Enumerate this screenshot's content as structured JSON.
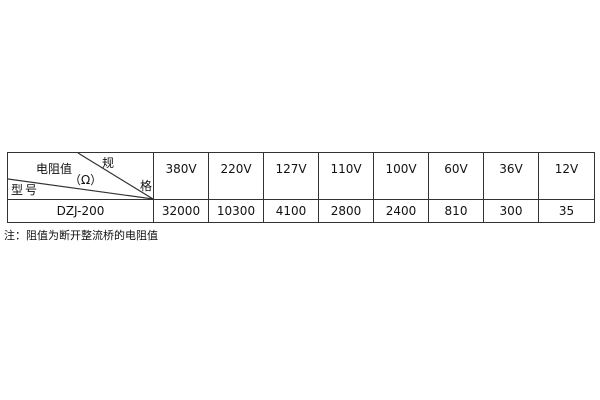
{
  "table": {
    "corner": {
      "spec_top": "规",
      "spec_bottom": "格",
      "resistance_label": "电阻值",
      "unit_label": "（Ω）",
      "model_label": "型号"
    },
    "voltages": [
      "380V",
      "220V",
      "127V",
      "110V",
      "100V",
      "60V",
      "36V",
      "12V"
    ],
    "model": "DZJ-200",
    "values": [
      "32000",
      "10300",
      "4100",
      "2800",
      "2400",
      "810",
      "300",
      "35"
    ]
  },
  "note": "注：阻值为断开整流桥的电阻值",
  "colors": {
    "border": "#333333",
    "text": "#111111",
    "background": "#ffffff"
  }
}
